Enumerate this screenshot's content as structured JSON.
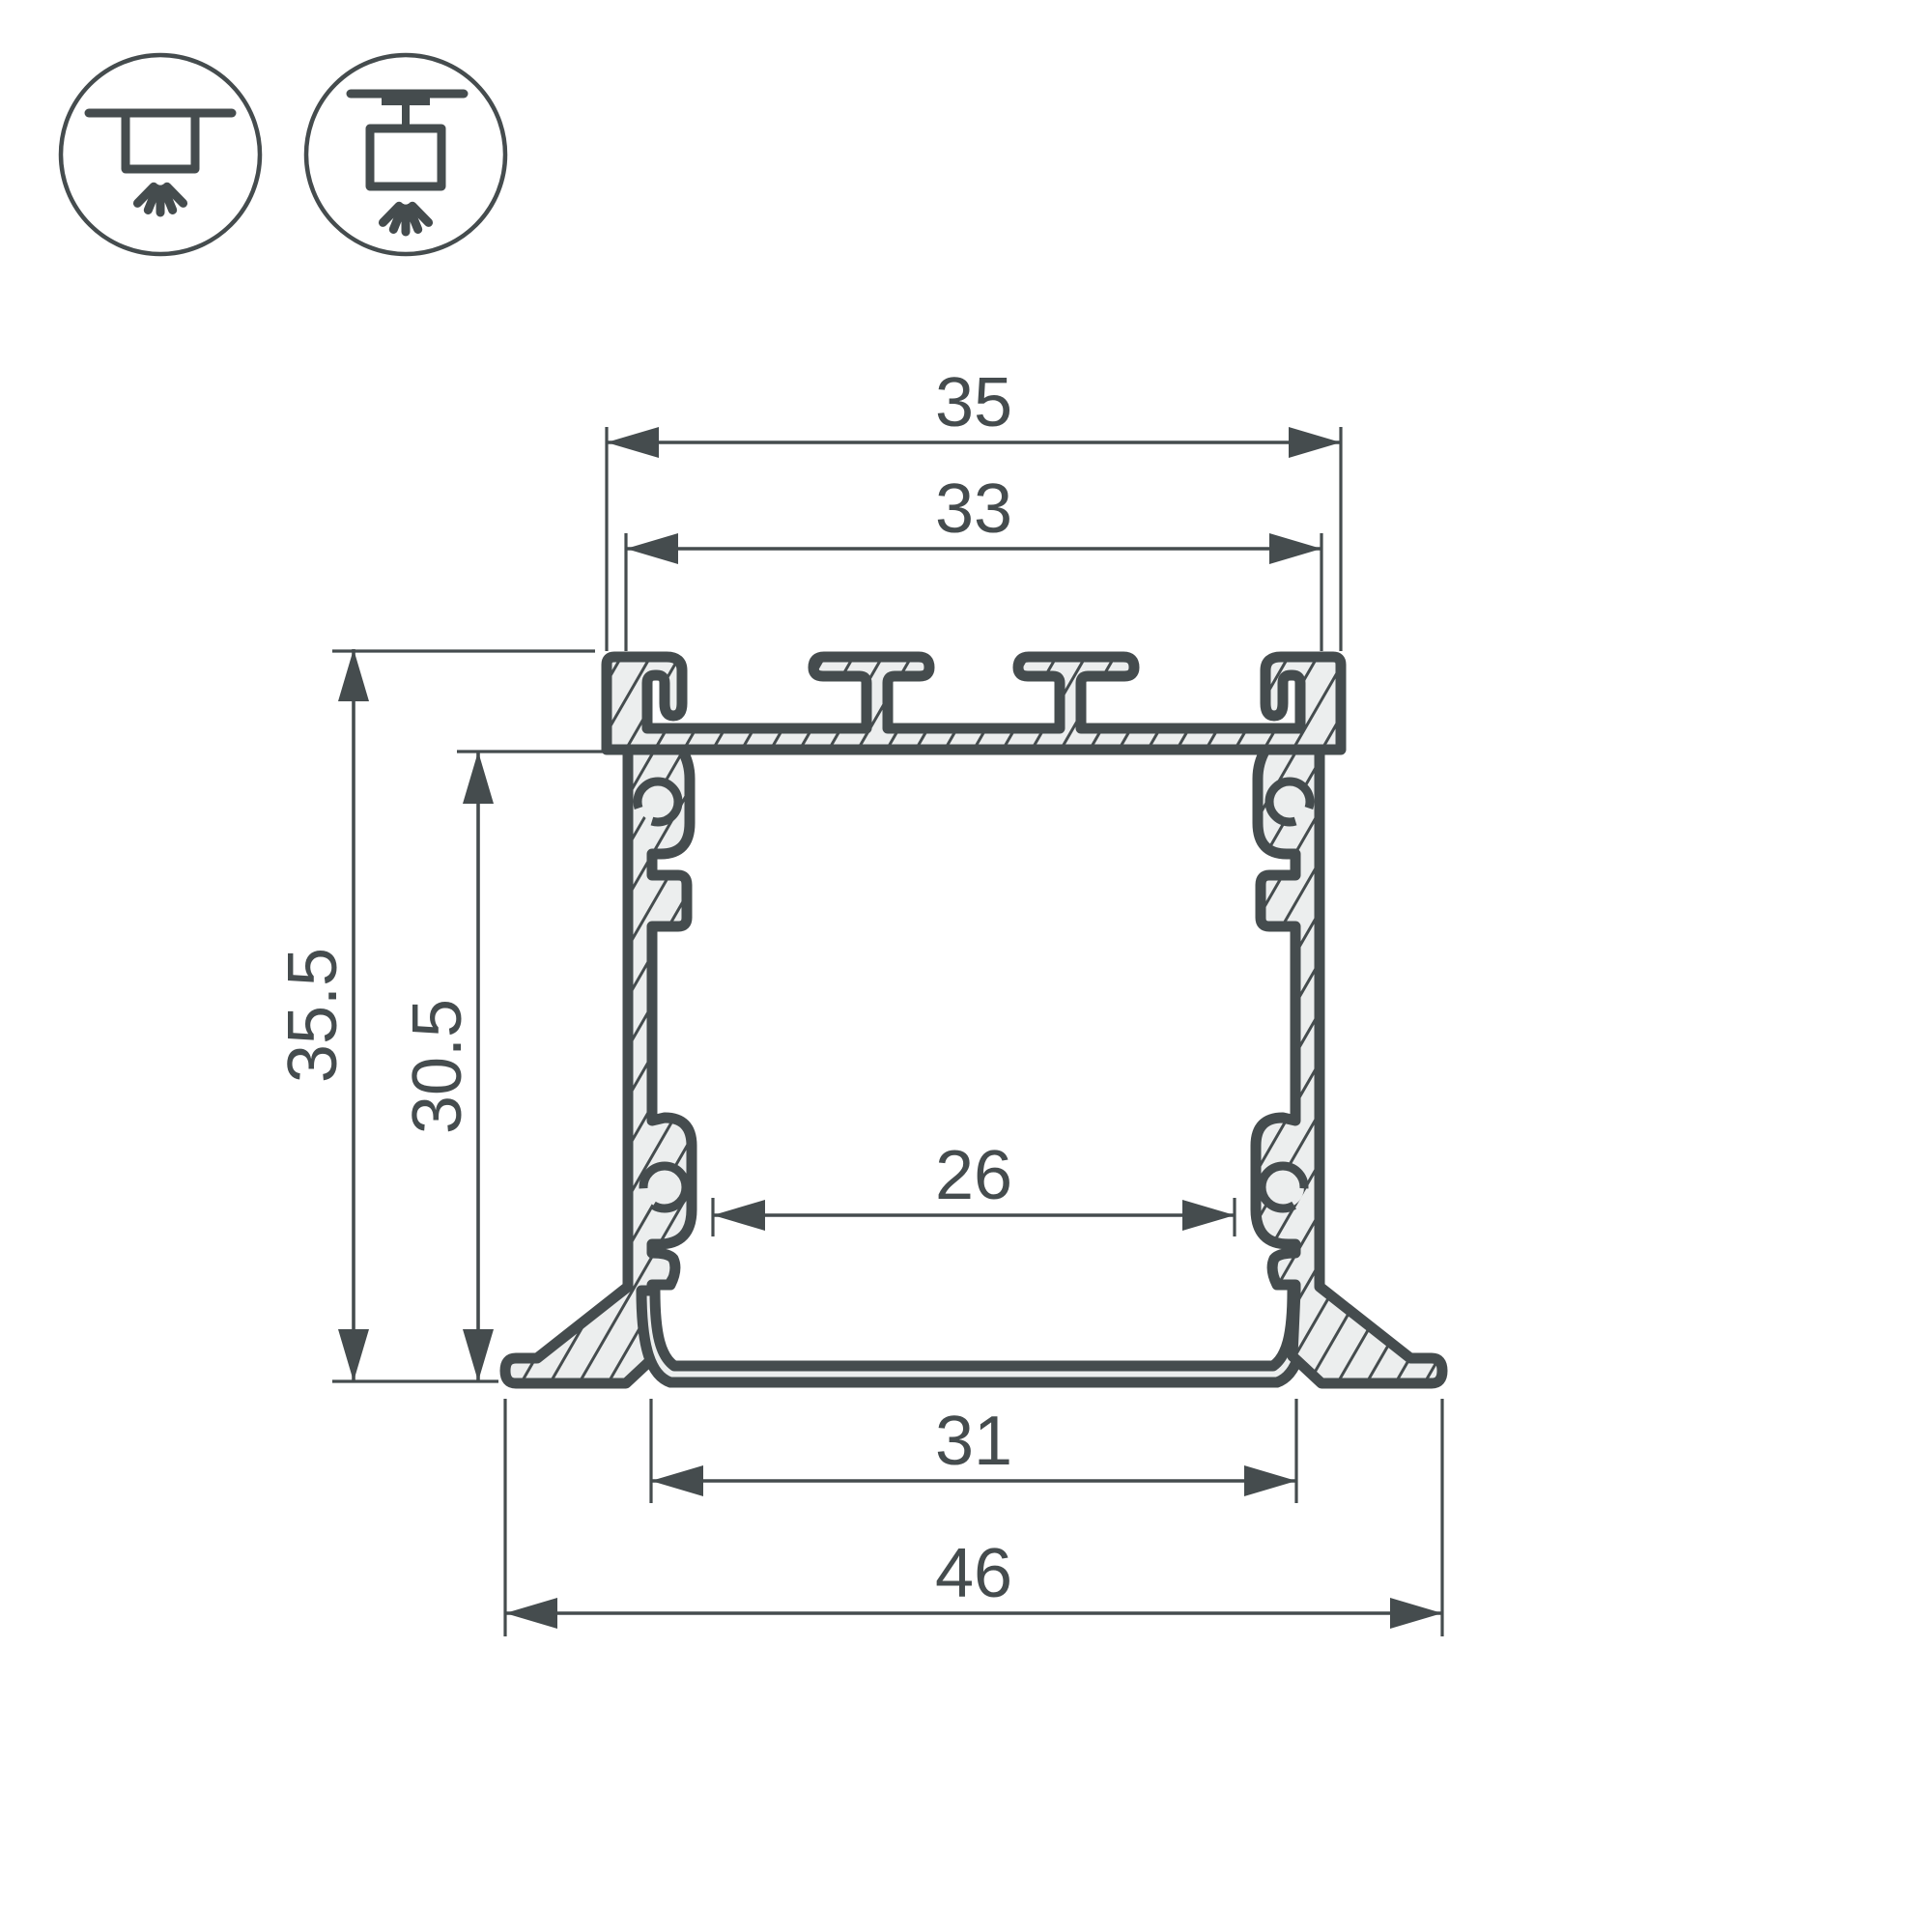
{
  "diagram": {
    "type": "led-profile-cross-section",
    "dimensions": {
      "top_width": "35",
      "inner_top_width": "33",
      "overall_height": "35.5",
      "inner_height": "30.5",
      "inner_bottom_width": "26",
      "bottom_recess_width": "31",
      "overall_width": "46"
    },
    "icons": [
      {
        "name": "recessed-mount-icon"
      },
      {
        "name": "suspended-mount-icon"
      }
    ],
    "colors": {
      "line": "#454c4e",
      "fill": "#eceeee",
      "background": "#ffffff"
    }
  }
}
